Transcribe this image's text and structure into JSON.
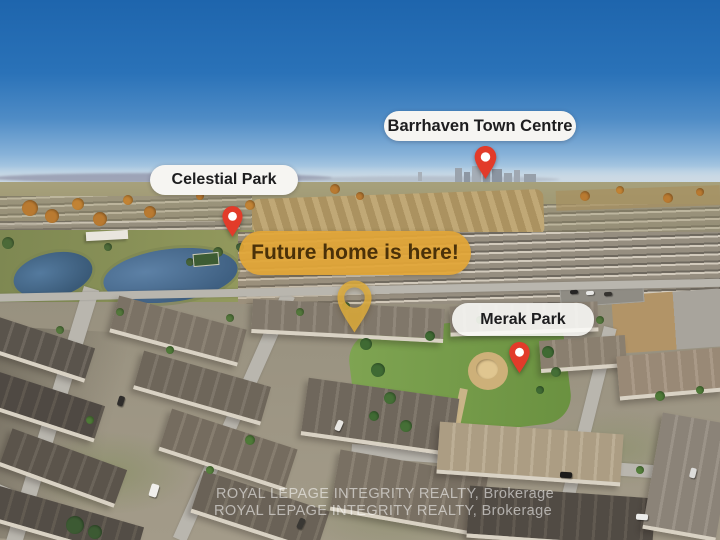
{
  "overlays": {
    "barrhaven_label": "Barrhaven Town Centre",
    "celestial_label": "Celestial Park",
    "future_banner": "Future home is here!",
    "merak_label": "Merak Park"
  },
  "watermark": {
    "line1": "ROYAL LEPAGE INTEGRITY REALTY, Brokerage",
    "line2": "ROYAL LEPAGE INTEGRITY REALTY, Brokerage"
  },
  "colors": {
    "pin_red": "#e23b2a",
    "home_marker_gold": "#dcab3c",
    "banner_gold": "#e2a636",
    "banner_text": "#4a3109",
    "label_pill_bg": "#f6f5f2",
    "label_text": "#1d1d1f",
    "watermark_white": "rgba(255,255,255,0.55)"
  }
}
